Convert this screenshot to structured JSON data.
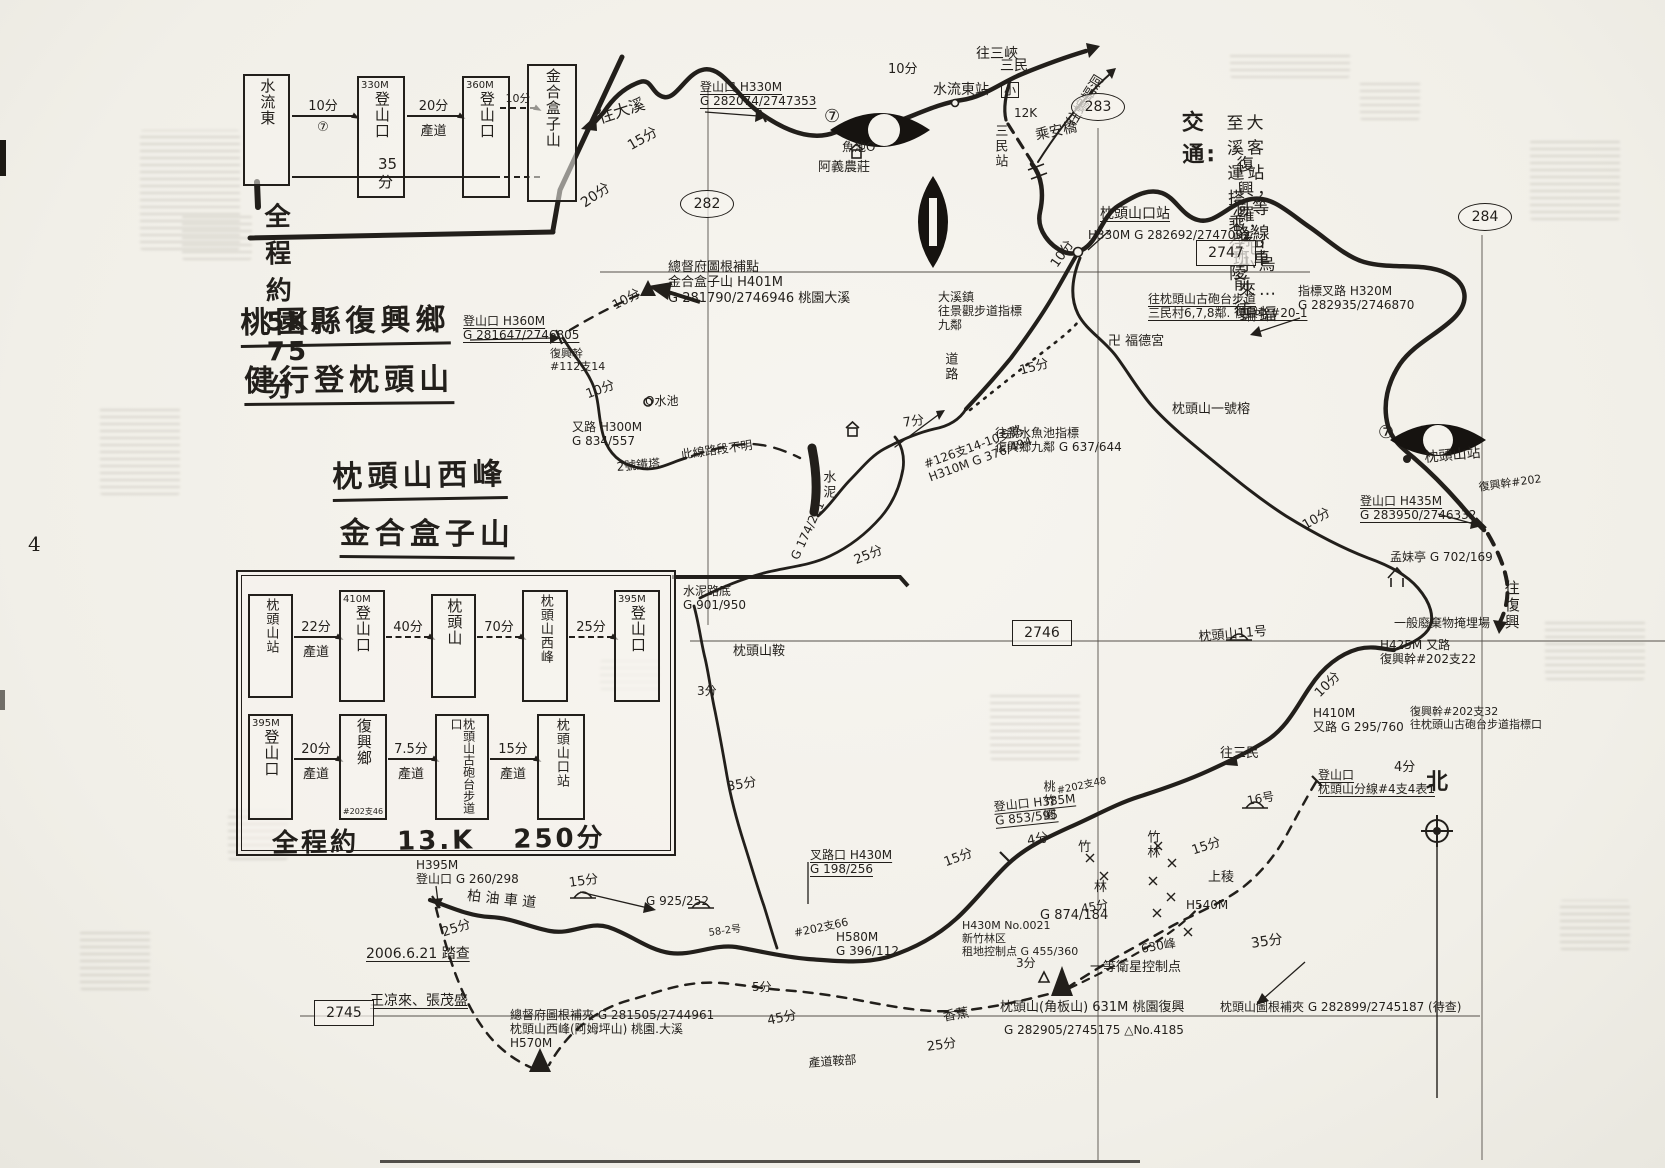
{
  "page": {
    "number": "4"
  },
  "title_block": {
    "lines": [
      "桃園縣復興鄉",
      "健行登枕頭山",
      "枕頭山西峰",
      "金合盒子山"
    ]
  },
  "route_short": {
    "boxes": [
      {
        "elev": "",
        "name": "水流東"
      },
      {
        "elev": "330M",
        "name": "登山口"
      },
      {
        "elev": "360M",
        "name": "登山口"
      },
      {
        "elev": "",
        "name": "金合盒子山"
      }
    ],
    "legs": [
      {
        "time": "10分",
        "via": "⑦"
      },
      {
        "time": "20分",
        "via": "產道"
      },
      {
        "time": "10分",
        "via": ""
      }
    ],
    "overall_time": "35分",
    "summary": "全程約5K. 75分"
  },
  "route_long": {
    "row1": {
      "boxes": [
        {
          "elev": "",
          "name": "枕頭山站"
        },
        {
          "elev": "410M",
          "name": "登山口"
        },
        {
          "elev": "",
          "name": "枕頭山"
        },
        {
          "elev": "",
          "name": "枕頭山西峰"
        },
        {
          "elev": "395M",
          "name": "登山口"
        }
      ],
      "legs": [
        {
          "time": "22分",
          "via": "產道"
        },
        {
          "time": "40分",
          "via": ""
        },
        {
          "time": "70分",
          "via": ""
        },
        {
          "time": "25分",
          "via": ""
        }
      ]
    },
    "row2": {
      "boxes": [
        {
          "elev": "395M",
          "name": "登山口",
          "sub": ""
        },
        {
          "elev": "",
          "name": "復興鄉",
          "sub": "#202支46"
        },
        {
          "elev": "",
          "name": "枕頭山古砲台步道口",
          "sub": ""
        },
        {
          "elev": "",
          "name": "枕頭山口站",
          "sub": ""
        }
      ],
      "legs": [
        {
          "time": "20分",
          "via": "產道"
        },
        {
          "time": "7.5分",
          "via": "產道"
        },
        {
          "time": "15分",
          "via": "產道"
        }
      ]
    },
    "summary": "全程約 13.K 250分"
  },
  "transport": {
    "heading": "交通:",
    "lines": [
      "至大溪客運站搭乘，往巴陵",
      "復興，羅浮，小烏來…蝙蝠",
      "洞等路線班車前往。"
    ]
  },
  "grid": {
    "ovals": [
      {
        "label": "282"
      },
      {
        "label": "283"
      },
      {
        "label": "284"
      }
    ],
    "boxes": [
      {
        "label": "2747"
      },
      {
        "label": "2746"
      },
      {
        "label": "2745"
      }
    ]
  },
  "compass_label": "北",
  "map_labels": [
    {
      "t": "往大溪",
      "x": 596,
      "y": 110,
      "s": 16,
      "r": -18
    },
    {
      "t": "15分",
      "x": 625,
      "y": 140,
      "s": 14,
      "r": -30
    },
    {
      "t": "20分",
      "x": 578,
      "y": 198,
      "s": 14,
      "r": -35
    },
    {
      "t": "登山口 H330M\nG 282074/2747353",
      "x": 700,
      "y": 80,
      "s": 12,
      "u": 1
    },
    {
      "t": "10分",
      "x": 888,
      "y": 62,
      "s": 13
    },
    {
      "t": "水流東站",
      "x": 933,
      "y": 82,
      "s": 14
    },
    {
      "t": "往三峽",
      "x": 976,
      "y": 46,
      "s": 14
    },
    {
      "t": "三民",
      "x": 1000,
      "y": 58,
      "s": 14
    },
    {
      "t": "小",
      "x": 1001,
      "y": 82,
      "s": 12,
      "sq": 1
    },
    {
      "t": "12K",
      "x": 1014,
      "y": 106,
      "s": 12
    },
    {
      "t": "三民站",
      "x": 992,
      "y": 124,
      "s": 13,
      "v": 1
    },
    {
      "t": "乘安橋",
      "x": 1034,
      "y": 128,
      "s": 14,
      "r": -12
    },
    {
      "t": "往蝙蝠洞",
      "x": 1064,
      "y": 120,
      "s": 14,
      "r": -58
    },
    {
      "t": "魚池O",
      "x": 842,
      "y": 140,
      "s": 12
    },
    {
      "t": "阿義農莊",
      "x": 818,
      "y": 160,
      "s": 13
    },
    {
      "t": "枕頭山口站",
      "x": 1100,
      "y": 206,
      "s": 14,
      "u": 1
    },
    {
      "t": "H330M G 282692/2747092",
      "x": 1088,
      "y": 228,
      "s": 12
    },
    {
      "t": "大溪鎮\n往景觀步道指標\n九鄰",
      "x": 938,
      "y": 290,
      "s": 12
    },
    {
      "t": "往枕頭山古砲台步道\n三民村6,7,8鄰. 復興幹#20-1",
      "x": 1148,
      "y": 292,
      "s": 12,
      "u": 1
    },
    {
      "t": "指標叉路 H320M\nG 282935/2746870",
      "x": 1298,
      "y": 284,
      "s": 12
    },
    {
      "t": "卍 福德宮",
      "x": 1108,
      "y": 334,
      "s": 13
    },
    {
      "t": "枕頭山一號榕",
      "x": 1172,
      "y": 402,
      "s": 13
    },
    {
      "t": "道路",
      "x": 942,
      "y": 352,
      "s": 13,
      "v": 1
    },
    {
      "t": "15分",
      "x": 1018,
      "y": 364,
      "s": 13,
      "r": -15
    },
    {
      "t": "10分",
      "x": 1048,
      "y": 262,
      "s": 13,
      "r": -55
    },
    {
      "t": "往親水魚池指標\n復興鄉九鄰 G 637/644",
      "x": 995,
      "y": 426,
      "s": 12
    },
    {
      "t": "7分",
      "x": 902,
      "y": 416,
      "s": 13,
      "r": -8
    },
    {
      "t": "#126支14-10支路\nH310M G 376/494",
      "x": 922,
      "y": 458,
      "s": 12,
      "r": -20
    },
    {
      "t": "水泥",
      "x": 820,
      "y": 470,
      "s": 13,
      "v": 1
    },
    {
      "t": "此線路段不明",
      "x": 680,
      "y": 448,
      "s": 12,
      "r": -8
    },
    {
      "t": "2號鐵塔",
      "x": 616,
      "y": 460,
      "s": 12,
      "r": -5
    },
    {
      "t": "又路 H300M\nG 834/557",
      "x": 572,
      "y": 420,
      "s": 12
    },
    {
      "t": "10分",
      "x": 584,
      "y": 388,
      "s": 13,
      "r": -20
    },
    {
      "t": "O水池",
      "x": 645,
      "y": 394,
      "s": 12
    },
    {
      "t": "復興幹\n#112支14",
      "x": 550,
      "y": 348,
      "s": 11
    },
    {
      "t": "登山口 H360M\nG 281647/2746805",
      "x": 463,
      "y": 314,
      "s": 12,
      "u": 1
    },
    {
      "t": "10分",
      "x": 610,
      "y": 300,
      "s": 13,
      "r": -28
    },
    {
      "t": "總督府圖根補點\n金合盒子山 H401M\nG 281790/2746946 桃園大溪",
      "x": 668,
      "y": 260,
      "s": 13
    },
    {
      "t": "G 174/221",
      "x": 788,
      "y": 556,
      "s": 12,
      "r": -65
    },
    {
      "t": "25分",
      "x": 852,
      "y": 554,
      "s": 13,
      "r": -22
    },
    {
      "t": "水泥路底\nG 901/950",
      "x": 683,
      "y": 584,
      "s": 12
    },
    {
      "t": "枕頭山鞍",
      "x": 733,
      "y": 644,
      "s": 13
    },
    {
      "t": "3分",
      "x": 697,
      "y": 684,
      "s": 12
    },
    {
      "t": "35分",
      "x": 726,
      "y": 780,
      "s": 13,
      "r": -10
    },
    {
      "t": "枕頭山站",
      "x": 1424,
      "y": 450,
      "s": 14,
      "r": -5
    },
    {
      "t": "復興幹#202",
      "x": 1478,
      "y": 482,
      "s": 11,
      "r": -8
    },
    {
      "t": "登山口 H435M\nG 283950/2746332",
      "x": 1360,
      "y": 494,
      "s": 12,
      "u": 1
    },
    {
      "t": "10分",
      "x": 1300,
      "y": 520,
      "s": 13,
      "r": -30
    },
    {
      "t": "孟妹亭 G 702/169",
      "x": 1390,
      "y": 550,
      "s": 12
    },
    {
      "t": "一般廢棄物掩埋場",
      "x": 1394,
      "y": 616,
      "s": 12
    },
    {
      "t": "往復興",
      "x": 1502,
      "y": 580,
      "s": 15,
      "v": 1
    },
    {
      "t": "枕頭山11号",
      "x": 1198,
      "y": 630,
      "s": 13,
      "r": -5
    },
    {
      "t": "H425M 又路\n復興幹#202支22",
      "x": 1380,
      "y": 638,
      "s": 12
    },
    {
      "t": "10分",
      "x": 1312,
      "y": 690,
      "s": 13,
      "r": -45
    },
    {
      "t": "H410M\n又路 G 295/760",
      "x": 1313,
      "y": 706,
      "s": 12
    },
    {
      "t": "復興幹#202支32\n往枕頭山古砲台步道指標口",
      "x": 1410,
      "y": 706,
      "s": 11
    },
    {
      "t": "4分",
      "x": 1394,
      "y": 760,
      "s": 13
    },
    {
      "t": "往三民",
      "x": 1220,
      "y": 746,
      "s": 13
    },
    {
      "t": "16号",
      "x": 1246,
      "y": 794,
      "s": 12,
      "r": -10
    },
    {
      "t": "登山口\n枕頭山分線#4支4表1",
      "x": 1318,
      "y": 768,
      "s": 12,
      "u": 1
    },
    {
      "t": "15分",
      "x": 1190,
      "y": 844,
      "s": 13,
      "r": -18
    },
    {
      "t": "上稜",
      "x": 1208,
      "y": 870,
      "s": 13
    },
    {
      "t": "H540M",
      "x": 1186,
      "y": 898,
      "s": 12
    },
    {
      "t": "竹林",
      "x": 1144,
      "y": 830,
      "s": 13,
      "v": 1
    },
    {
      "t": "35分",
      "x": 1250,
      "y": 936,
      "s": 14,
      "r": -8
    },
    {
      "t": "桃竹園",
      "x": 1042,
      "y": 780,
      "s": 12,
      "v": 1
    },
    {
      "t": "4分",
      "x": 1026,
      "y": 834,
      "s": 13,
      "r": -10
    },
    {
      "t": "竹",
      "x": 1078,
      "y": 840,
      "s": 13
    },
    {
      "t": "林",
      "x": 1094,
      "y": 880,
      "s": 13
    },
    {
      "t": "45分",
      "x": 1080,
      "y": 902,
      "s": 12,
      "r": -10
    },
    {
      "t": "登山口 H385M\nG 853/595",
      "x": 993,
      "y": 800,
      "s": 12,
      "u": 1,
      "r": -6
    },
    {
      "t": "#202支48",
      "x": 1056,
      "y": 786,
      "s": 10,
      "r": -12
    },
    {
      "t": "15分",
      "x": 942,
      "y": 856,
      "s": 13,
      "r": -20
    },
    {
      "t": "叉路口 H430M\nG 198/256",
      "x": 810,
      "y": 848,
      "s": 12,
      "u": 1
    },
    {
      "t": "#202支66",
      "x": 793,
      "y": 928,
      "s": 11,
      "r": -12
    },
    {
      "t": "H430M No.0021\n新竹林区\n租地控制点 G 455/360",
      "x": 962,
      "y": 920,
      "s": 11
    },
    {
      "t": "G 874/184",
      "x": 1040,
      "y": 908,
      "s": 13
    },
    {
      "t": "H580M\nG 396/112",
      "x": 836,
      "y": 930,
      "s": 12
    },
    {
      "t": "5分",
      "x": 752,
      "y": 980,
      "s": 12
    },
    {
      "t": "45分",
      "x": 766,
      "y": 1014,
      "s": 13,
      "r": -12
    },
    {
      "t": "25分",
      "x": 440,
      "y": 926,
      "s": 13,
      "r": -18
    },
    {
      "t": "H395M\n登山口 G 260/298",
      "x": 416,
      "y": 858,
      "s": 12
    },
    {
      "t": "柏 油 車 道",
      "x": 468,
      "y": 888,
      "s": 14,
      "r": 6
    },
    {
      "t": "15分",
      "x": 568,
      "y": 876,
      "s": 13,
      "r": -8
    },
    {
      "t": "G 925/252",
      "x": 646,
      "y": 894,
      "s": 12
    },
    {
      "t": "58-2号",
      "x": 708,
      "y": 928,
      "s": 10,
      "r": -8
    },
    {
      "t": "總督府圖根補夾 G 281505/2744961\n枕頭山西峰(阿姆坪山) 桃園.大溪\nH570M",
      "x": 510,
      "y": 1008,
      "s": 12
    },
    {
      "t": "2006.6.21 踏查",
      "x": 366,
      "y": 946,
      "s": 14,
      "u": 1
    },
    {
      "t": "王凉來、張茂盛",
      "x": 370,
      "y": 993,
      "s": 14,
      "u": 1
    },
    {
      "t": "香蕉",
      "x": 942,
      "y": 1010,
      "s": 13,
      "r": -10
    },
    {
      "t": "25分",
      "x": 926,
      "y": 1040,
      "s": 13,
      "r": -8
    },
    {
      "t": "產道鞍部",
      "x": 808,
      "y": 1056,
      "s": 12,
      "r": -4
    },
    {
      "t": "3分",
      "x": 1016,
      "y": 956,
      "s": 12
    },
    {
      "t": "一等衛星控制点",
      "x": 1090,
      "y": 960,
      "s": 13
    },
    {
      "t": "630峰",
      "x": 1140,
      "y": 942,
      "s": 12,
      "r": -10
    },
    {
      "t": "枕頭山(角板山) 631M 桃園復興",
      "x": 1000,
      "y": 1000,
      "s": 13
    },
    {
      "t": "G 282905/2745175  △No.4185",
      "x": 1004,
      "y": 1023,
      "s": 12
    },
    {
      "t": "枕頭山圖根補夾 G 282899/2745187 (待查)",
      "x": 1220,
      "y": 1000,
      "s": 12
    },
    {
      "t": "⑦",
      "x": 824,
      "y": 106,
      "s": 18
    },
    {
      "t": "⑦",
      "x": 1378,
      "y": 422,
      "s": 18
    }
  ]
}
